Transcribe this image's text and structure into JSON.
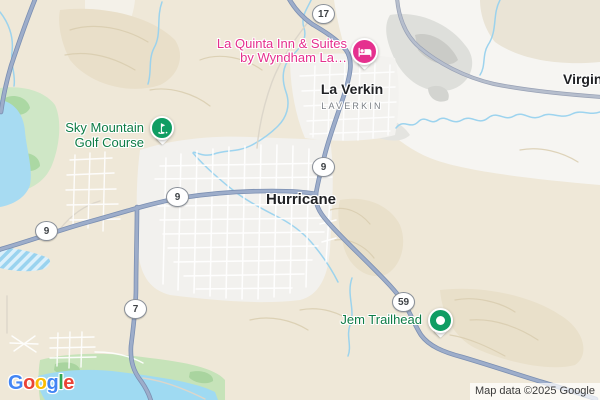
{
  "map": {
    "attribution": "Map data ©2025 Google",
    "labels": {
      "hotel": {
        "line1": "La Quinta Inn & Suites",
        "line2": "by Wyndham La…"
      },
      "la_verkin": {
        "name": "La Verkin",
        "subtitle": "LAVERKIN"
      },
      "hurricane": {
        "name": "Hurricane"
      },
      "virgin": {
        "name": "Virgin"
      },
      "golf": {
        "line1": "Sky Mountain",
        "line2": "Golf Course"
      },
      "jem": {
        "name": "Jem Trailhead"
      }
    },
    "shields": [
      {
        "route": "17"
      },
      {
        "route": "9"
      },
      {
        "route": "9"
      },
      {
        "route": "9"
      },
      {
        "route": "7"
      },
      {
        "route": "59"
      }
    ],
    "icons": {
      "hotel_marker": "bed-icon",
      "golf_marker": "golf-flag-icon",
      "trailhead_marker": "dot-icon"
    },
    "colors": {
      "hotel_pink": "#E5308E",
      "poi_green_text": "#0E7C46",
      "marker_green": "#0F9D63",
      "city_label": "#202124",
      "highway_fill": "#9DADCA",
      "road_gray_fill": "#B6BECD",
      "water": "#A7DBF2",
      "desert": "#EFE8D8"
    }
  },
  "logo": {
    "text": "Google",
    "letters": [
      {
        "ch": "G",
        "color": "#4285F4"
      },
      {
        "ch": "o",
        "color": "#EA4335"
      },
      {
        "ch": "o",
        "color": "#FBBC05"
      },
      {
        "ch": "g",
        "color": "#4285F4"
      },
      {
        "ch": "l",
        "color": "#34A853"
      },
      {
        "ch": "e",
        "color": "#EA4335"
      }
    ]
  }
}
